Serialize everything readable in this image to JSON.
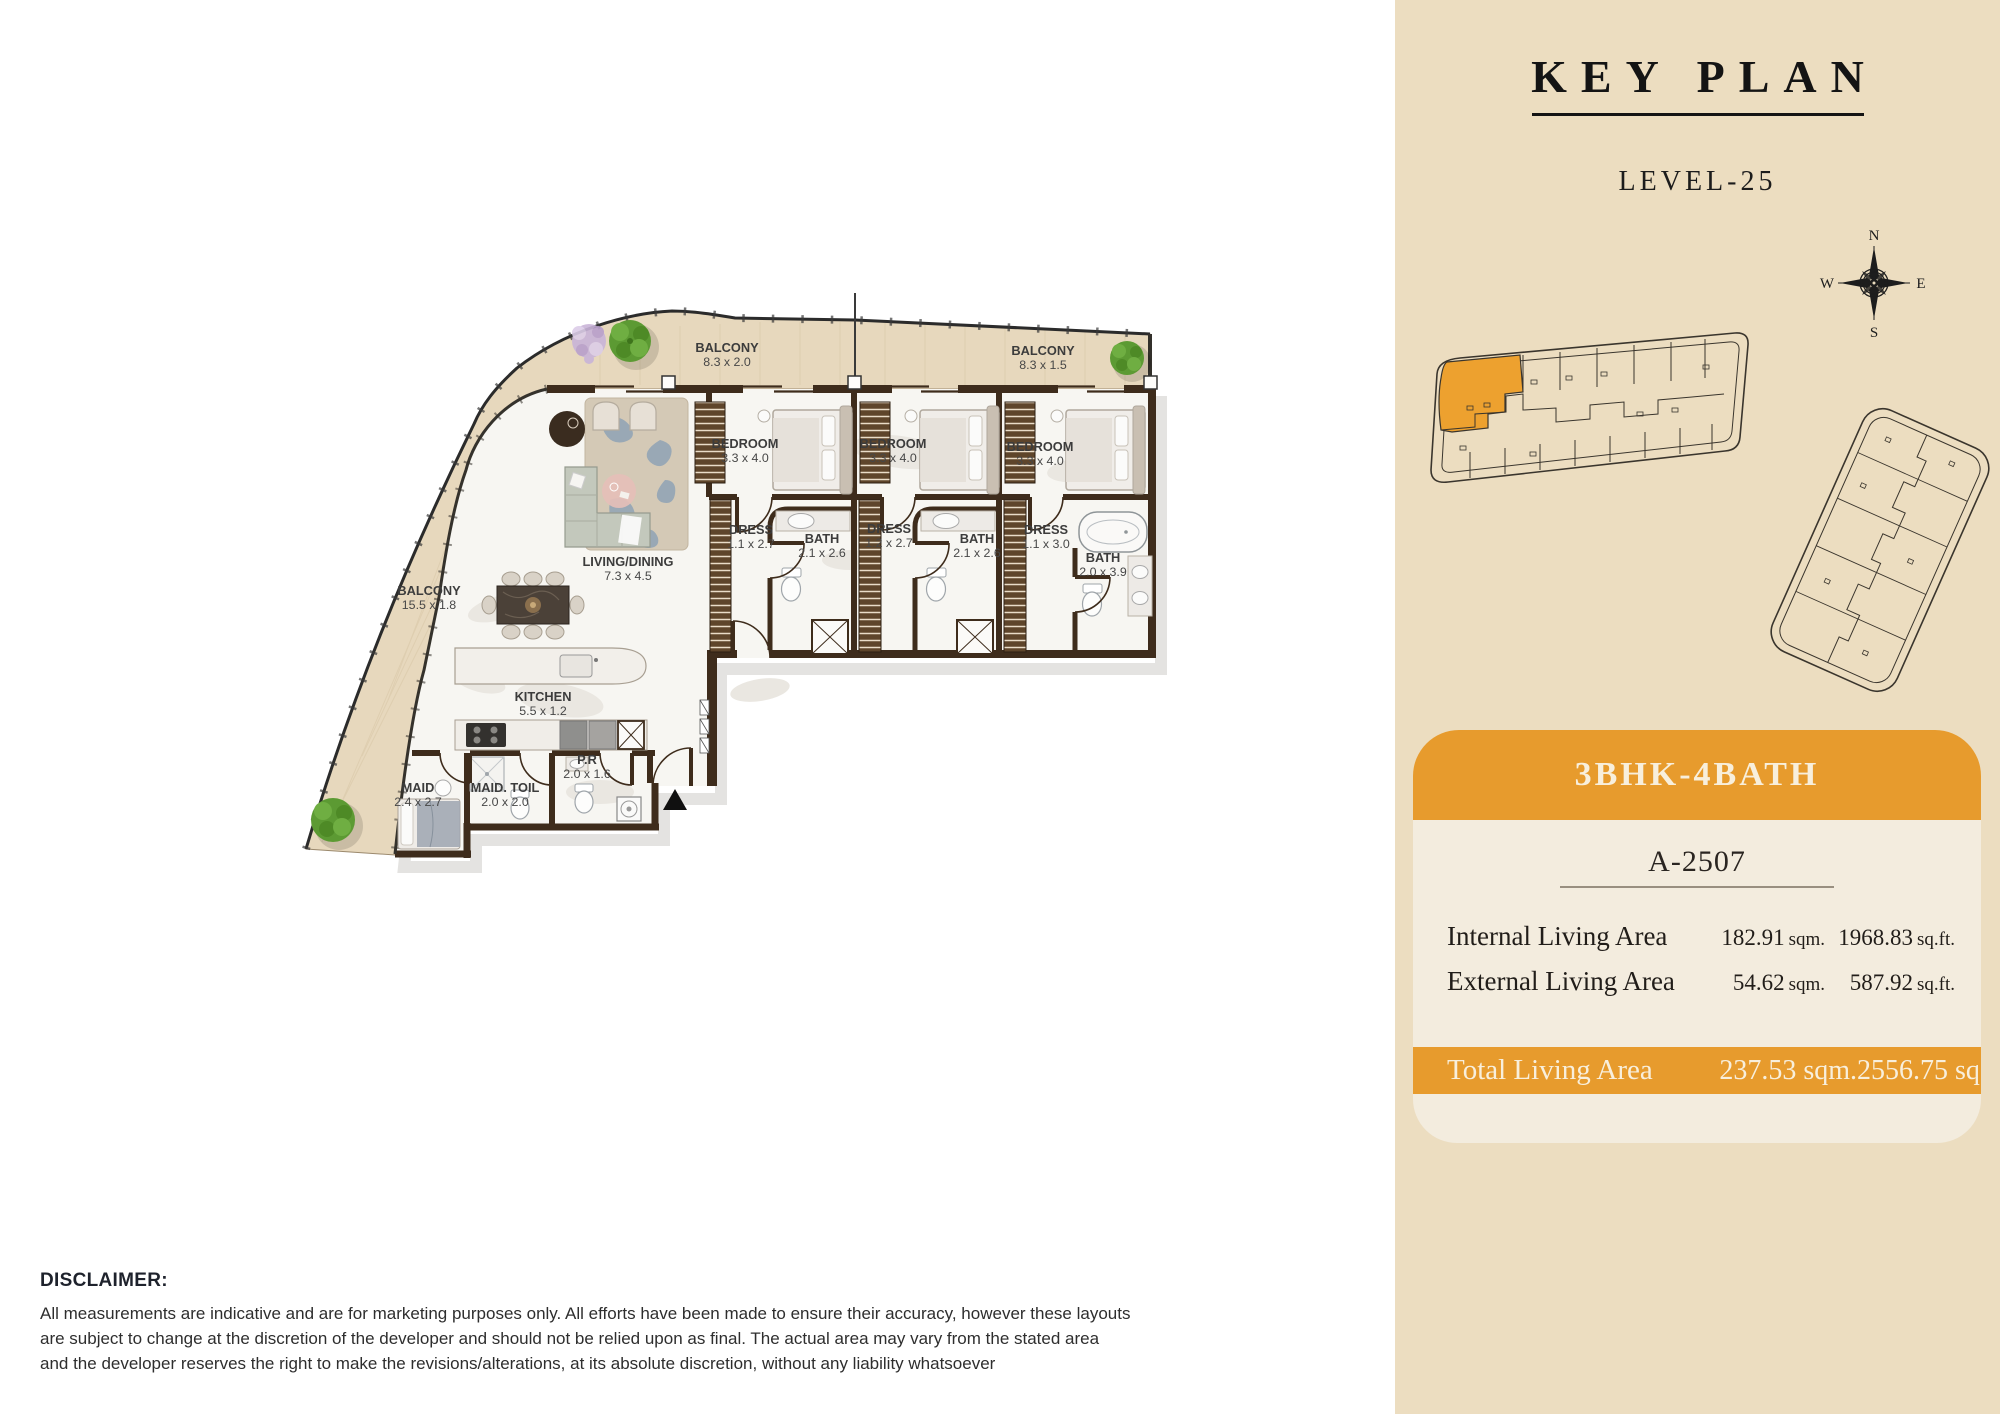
{
  "floor_plan": {
    "rooms": [
      {
        "name": "BALCONY",
        "dims": "8.3 x 2.0"
      },
      {
        "name": "BALCONY",
        "dims": "8.3 x 1.5"
      },
      {
        "name": "BEDROOM",
        "dims": "3.3 x 4.0"
      },
      {
        "name": "BEDROOM",
        "dims": "3.3 x 4.0"
      },
      {
        "name": "BEDROOM",
        "dims": "3.3 x 4.0"
      },
      {
        "name": "DRESS",
        "dims": "1.1 x 2.7"
      },
      {
        "name": "BATH",
        "dims": "2.1 x 2.6"
      },
      {
        "name": "DRESS",
        "dims": "1.2 x 2.7"
      },
      {
        "name": "BATH",
        "dims": "2.1 x 2.6"
      },
      {
        "name": "DRESS",
        "dims": "1.1 x 3.0"
      },
      {
        "name": "BATH",
        "dims": "2.0 x 3.9"
      },
      {
        "name": "LIVING/DINING",
        "dims": "7.3 x 4.5"
      },
      {
        "name": "BALCONY",
        "dims": "15.5 x 1.8"
      },
      {
        "name": "KITCHEN",
        "dims": "5.5 x 1.2"
      },
      {
        "name": "MAID",
        "dims": "2.4 x 2.7"
      },
      {
        "name": "MAID. TOIL",
        "dims": "2.0 x 2.0"
      },
      {
        "name": "P.R",
        "dims": "2.0 x 1.6"
      }
    ]
  },
  "keyplan": {
    "title": "KEY PLAN",
    "level": "LEVEL-25",
    "compass": {
      "n": "N",
      "e": "E",
      "s": "S",
      "w": "W"
    }
  },
  "unit_card": {
    "type": "3BHK-4BATH",
    "unit_no": "A-2507",
    "rows": [
      {
        "label": "Internal Living Area",
        "value_sqm": "182.91",
        "unit_sqm": "sqm.",
        "value_sqft": "1968.83",
        "unit_sqft": "sq.ft."
      },
      {
        "label": "External Living Area",
        "value_sqm": "54.62",
        "unit_sqm": "sqm.",
        "value_sqft": "587.92",
        "unit_sqft": "sq.ft."
      }
    ],
    "total": {
      "label": "Total Living Area",
      "sqm": "237.53 sqm.",
      "sqft": "2556.75 sq.ft."
    }
  },
  "disclaimer": {
    "heading": "DISCLAIMER:",
    "lines": [
      "All measurements are indicative and are for marketing purposes only. All efforts have been made to ensure their accuracy, however these layouts",
      "are subject to change at the discretion of the developer and should not be relied upon as final. The actual area may vary from the stated area",
      "and the developer reserves the right to make the revisions/alterations, at its absolute discretion, without any liability whatsoever"
    ]
  },
  "colors": {
    "accent_orange": "#E79B2D",
    "panel_beige": "#ECDDC0",
    "card_cream": "#F3ECDE",
    "wall_brown": "#3E2C1C",
    "balcony_wood": "#E7D8BD"
  }
}
